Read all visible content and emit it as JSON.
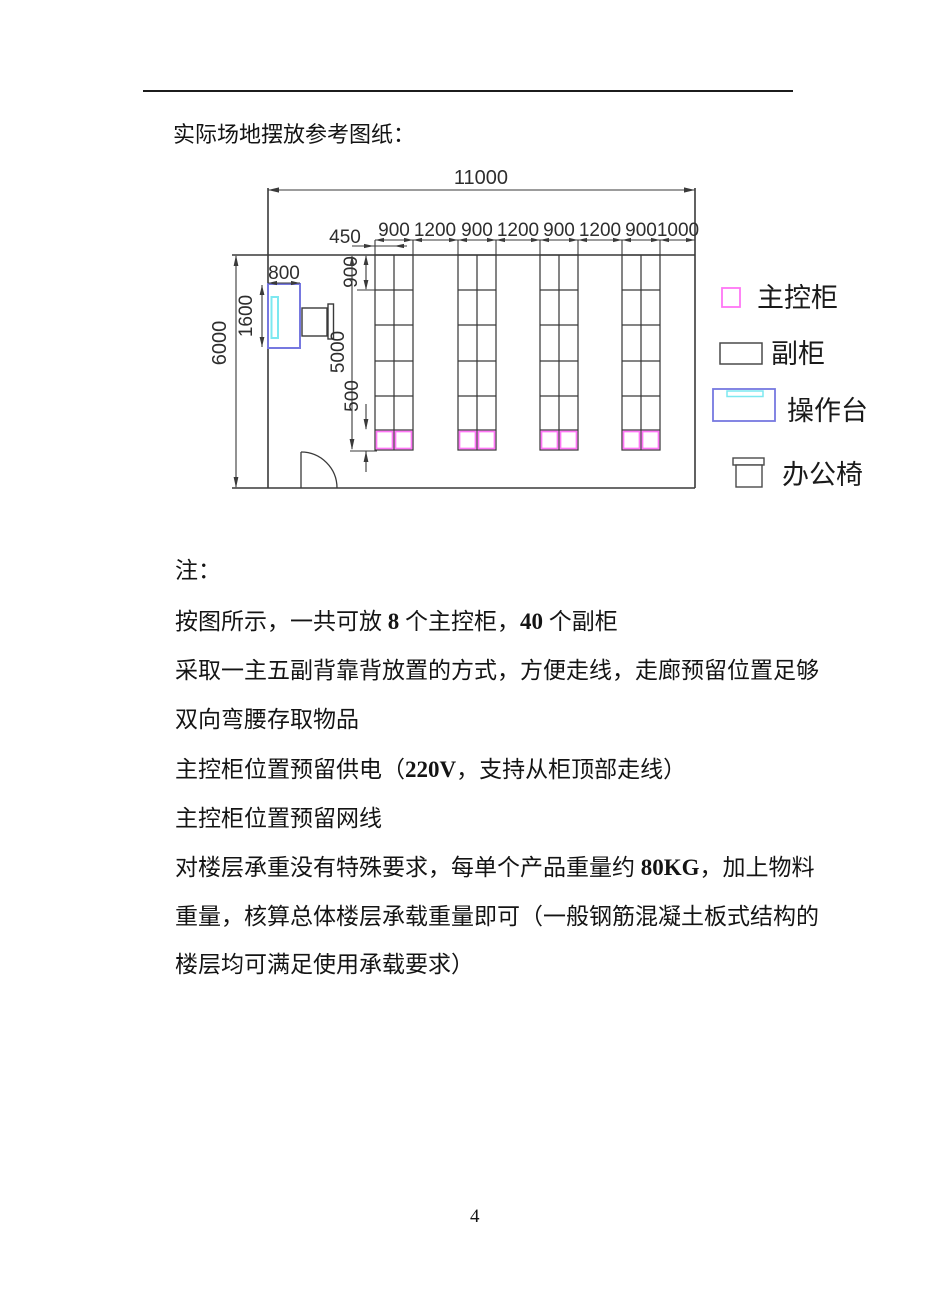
{
  "page": {
    "title": "实际场地摆放参考图纸：",
    "page_number": "4"
  },
  "diagram": {
    "dims": {
      "overall_width": "11000",
      "room_depth": "6000",
      "top_row": [
        "900",
        "1200",
        "900",
        "1200",
        "900",
        "1200",
        "900",
        "1000"
      ],
      "cabinet_depth": "450",
      "desk_width": "800",
      "desk_length": "1600",
      "first_rack_row": "900",
      "rack_length": "5000",
      "main_cabinet_row": "500"
    },
    "legend": [
      {
        "label": "主控柜",
        "symbol": "pink-square"
      },
      {
        "label": "副柜",
        "symbol": "gray-rectangle"
      },
      {
        "label": "操作台",
        "symbol": "blue-console"
      },
      {
        "label": "办公椅",
        "symbol": "chair"
      }
    ],
    "colors": {
      "main_cabinet": "#ff76f6",
      "console_border": "#7678e0",
      "console_screen": "#7de8f0",
      "line": "#3a3a3a"
    }
  },
  "notes": {
    "heading": "注：",
    "lines": [
      {
        "parts": [
          {
            "t": "按图所示，一共可放 "
          },
          {
            "t": "8",
            "b": 1
          },
          {
            "t": " 个主控柜，"
          },
          {
            "t": "40",
            "b": 1
          },
          {
            "t": " 个副柜"
          }
        ]
      },
      {
        "parts": [
          {
            "t": "采取一主五副背靠背放置的方式，方便走线，走廊预留位置足够"
          }
        ]
      },
      {
        "parts": [
          {
            "t": "双向弯腰存取物品"
          }
        ]
      },
      {
        "parts": [
          {
            "t": "主控柜位置预留供电（"
          },
          {
            "t": "220V",
            "b": 1
          },
          {
            "t": "，支持从柜顶部走线）"
          }
        ]
      },
      {
        "parts": [
          {
            "t": "主控柜位置预留网线"
          }
        ]
      },
      {
        "parts": [
          {
            "t": "对楼层承重没有特殊要求，每单个产品重量约 "
          },
          {
            "t": "80KG",
            "b": 1
          },
          {
            "t": "，加上物料"
          }
        ]
      },
      {
        "parts": [
          {
            "t": "重量，核算总体楼层承载重量即可（一般钢筋混凝土板式结构的"
          }
        ]
      },
      {
        "parts": [
          {
            "t": "楼层均可满足使用承载要求）"
          }
        ]
      }
    ]
  }
}
